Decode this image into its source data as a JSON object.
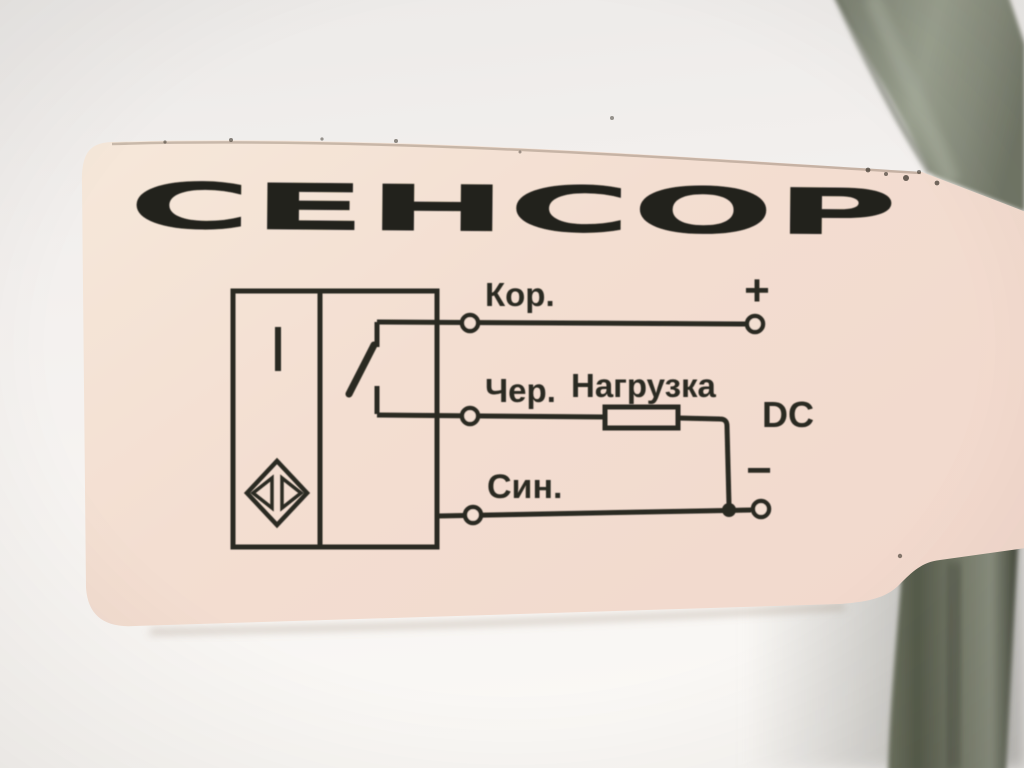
{
  "label": {
    "logo": "СЕНСОР",
    "wiring": {
      "brown": "Кор.",
      "black": "Чер.",
      "load": "Нагрузка",
      "blue": "Син.",
      "supply": "DC",
      "plus": "+",
      "minus": "−"
    }
  },
  "icons": {
    "sensor_symbol": "inductive-proximity-diamond-icon",
    "switch_symbol": "normally-open-contact-icon",
    "load_symbol": "resistor-rectangle-icon",
    "terminal_symbol": "open-circle-terminal-icon"
  },
  "colors": {
    "print": "#2b2922",
    "sticker": "#f3e0d3",
    "cable": "#8d9284",
    "background": "#f0eeec"
  }
}
